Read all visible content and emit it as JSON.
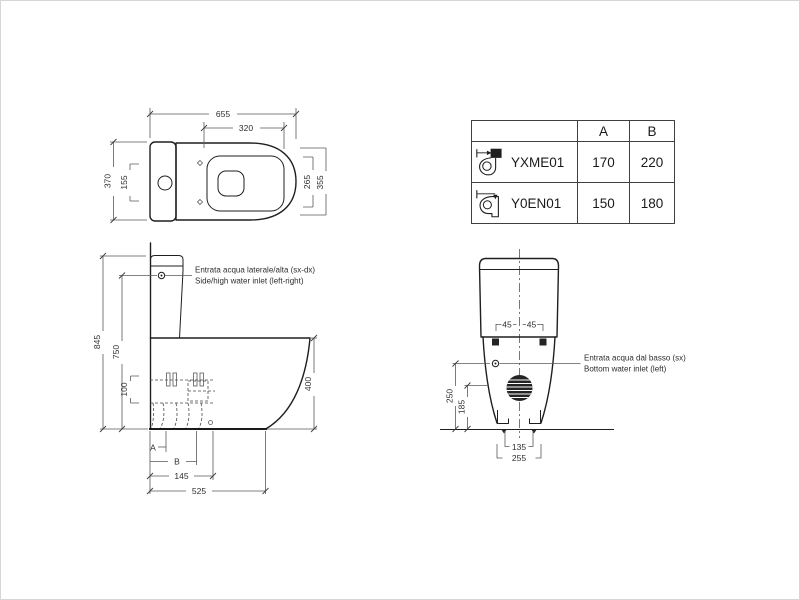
{
  "top_view": {
    "d655": "655",
    "d320": "320",
    "d370": "370",
    "d155": "155",
    "d265": "265",
    "d355": "355"
  },
  "side_view": {
    "d845": "845",
    "d750": "750",
    "d100": "100",
    "d400": "400",
    "dA": "A",
    "dB": "B",
    "d145": "145",
    "d525": "525",
    "note_it": "Entrata acqua laterale/alta (sx-dx)",
    "note_en": "Side/high water inlet (left-right)"
  },
  "back_view": {
    "d45l": "45",
    "d45r": "45",
    "d250": "250",
    "d185": "185",
    "d135": "135",
    "d255": "255",
    "note_it": "Entrata acqua dal basso (sx)",
    "note_en": "Bottom water inlet (left)"
  },
  "table": {
    "cols": {
      "a": "A",
      "b": "B"
    },
    "rows": [
      {
        "code": "YXME01",
        "icon": "p-trap-wall-outlet-icon",
        "a": "170",
        "b": "220"
      },
      {
        "code": "Y0EN01",
        "icon": "s-trap-floor-outlet-icon",
        "a": "150",
        "b": "180"
      }
    ]
  },
  "colors": {
    "outline": "#1f1f1f",
    "dimension": "#5a5a5a",
    "text": "#2e2e2e",
    "fill_dark": "#242424"
  }
}
